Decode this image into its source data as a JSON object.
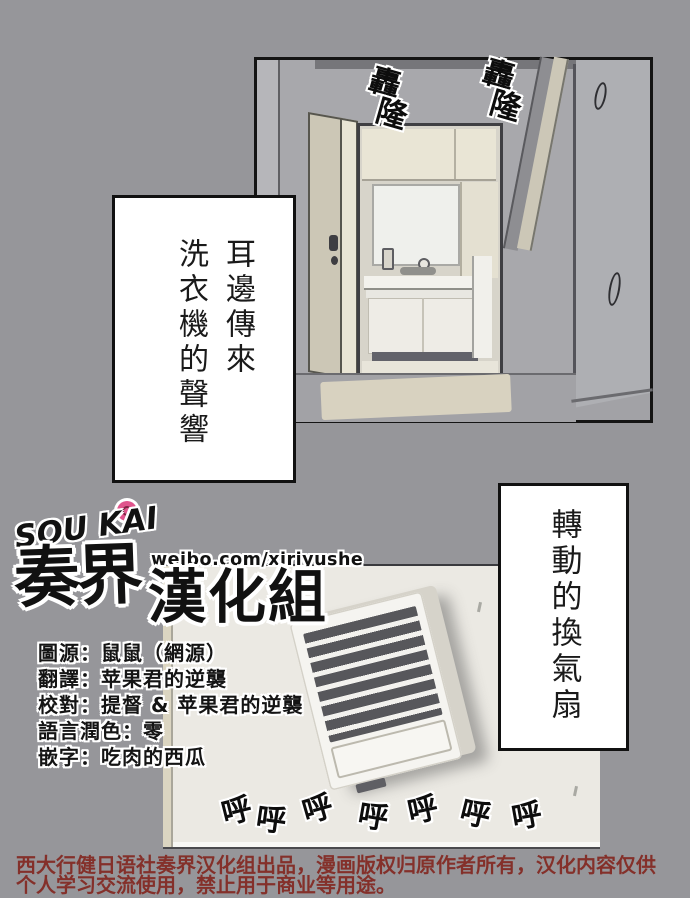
{
  "colors": {
    "page_bg": "#96969a",
    "panel_wall": "#a8a8ac",
    "lower_wall": "#ebe9e3",
    "footer_red": "#84302a",
    "flower_pink": "#e0548c",
    "paper_white": "#ffffff",
    "ink_black": "#111111"
  },
  "sfx": {
    "rumble": [
      "轟",
      "隆"
    ],
    "fan": [
      "呼",
      "呼",
      "呼",
      "呼",
      "呼",
      "呼",
      "呼"
    ]
  },
  "captions": {
    "left_lines": [
      "耳邊傳來",
      "洗衣機的聲響"
    ],
    "right": "轉動的換氣扇"
  },
  "logo": {
    "romaji": "SOU KAI",
    "weibo": "weibo.com/xjriyushe",
    "name_main": "奏界",
    "name_rest": "漢化組"
  },
  "credits": {
    "lines": [
      "圖源：鼠鼠（網源）",
      "翻譯：苹果君的逆襲",
      "校對：提督 & 苹果君的逆襲",
      "語言潤色：零",
      "嵌字：吃肉的西瓜"
    ]
  },
  "footer": {
    "line1": "西大行健日语社奏界汉化组出品，漫画版权归原作者所有，汉化内容仅供",
    "line2": "个人学习交流使用，禁止用于商业等用途。"
  }
}
